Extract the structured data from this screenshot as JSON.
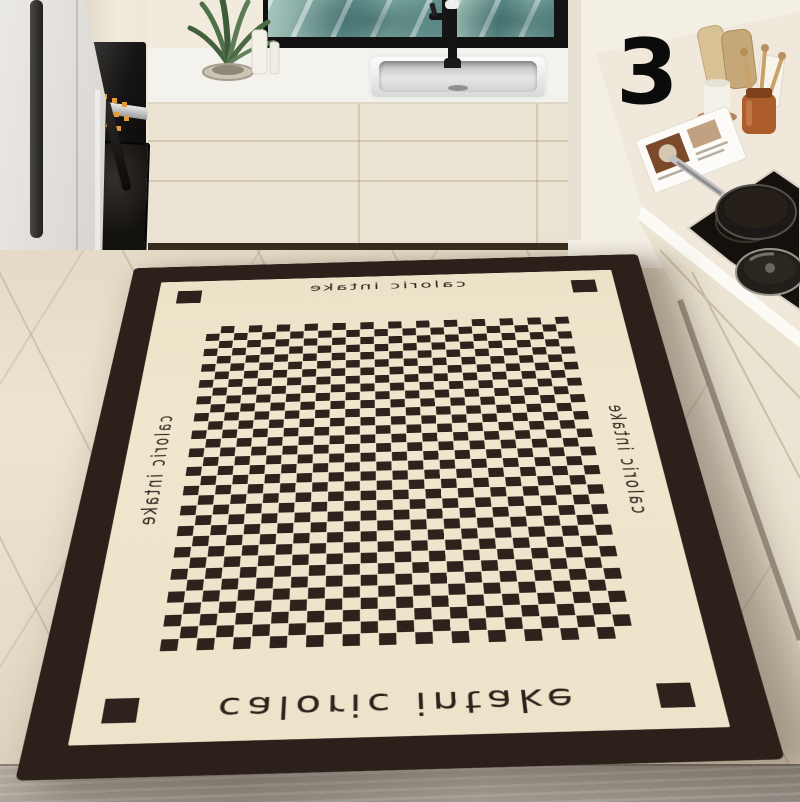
{
  "overlay": {
    "variant_number": "3"
  },
  "mat": {
    "texts": {
      "top": "caloric intake",
      "bottom": "caloric intake",
      "left": "caloric intake",
      "right": "caloric intake"
    },
    "pattern": {
      "style": "checkerboard",
      "columns": 26,
      "rows": 34,
      "corner_squares": 4
    }
  },
  "theme": {
    "mat-border": "#2b211a",
    "mat-field": "#efe6cd",
    "check-dark": "#2d231c",
    "mat-shadow": "rgba(60,48,35,0.40)",
    "wall": "#f1ebdd",
    "wall-right": "#f4efe5",
    "counter": "#f4f2ed",
    "cabinet": "#ebe3d1",
    "cab-seam": "rgba(150,130,95,0.28)",
    "toekick": "#382c21",
    "water-deep": "#5d8b89",
    "water-light": "#a9c6bd",
    "fridge-light": "#ebe9e6",
    "fridge-dark": "#cfccc8",
    "display": "#e59b36",
    "digit": "#0b0b0b"
  }
}
